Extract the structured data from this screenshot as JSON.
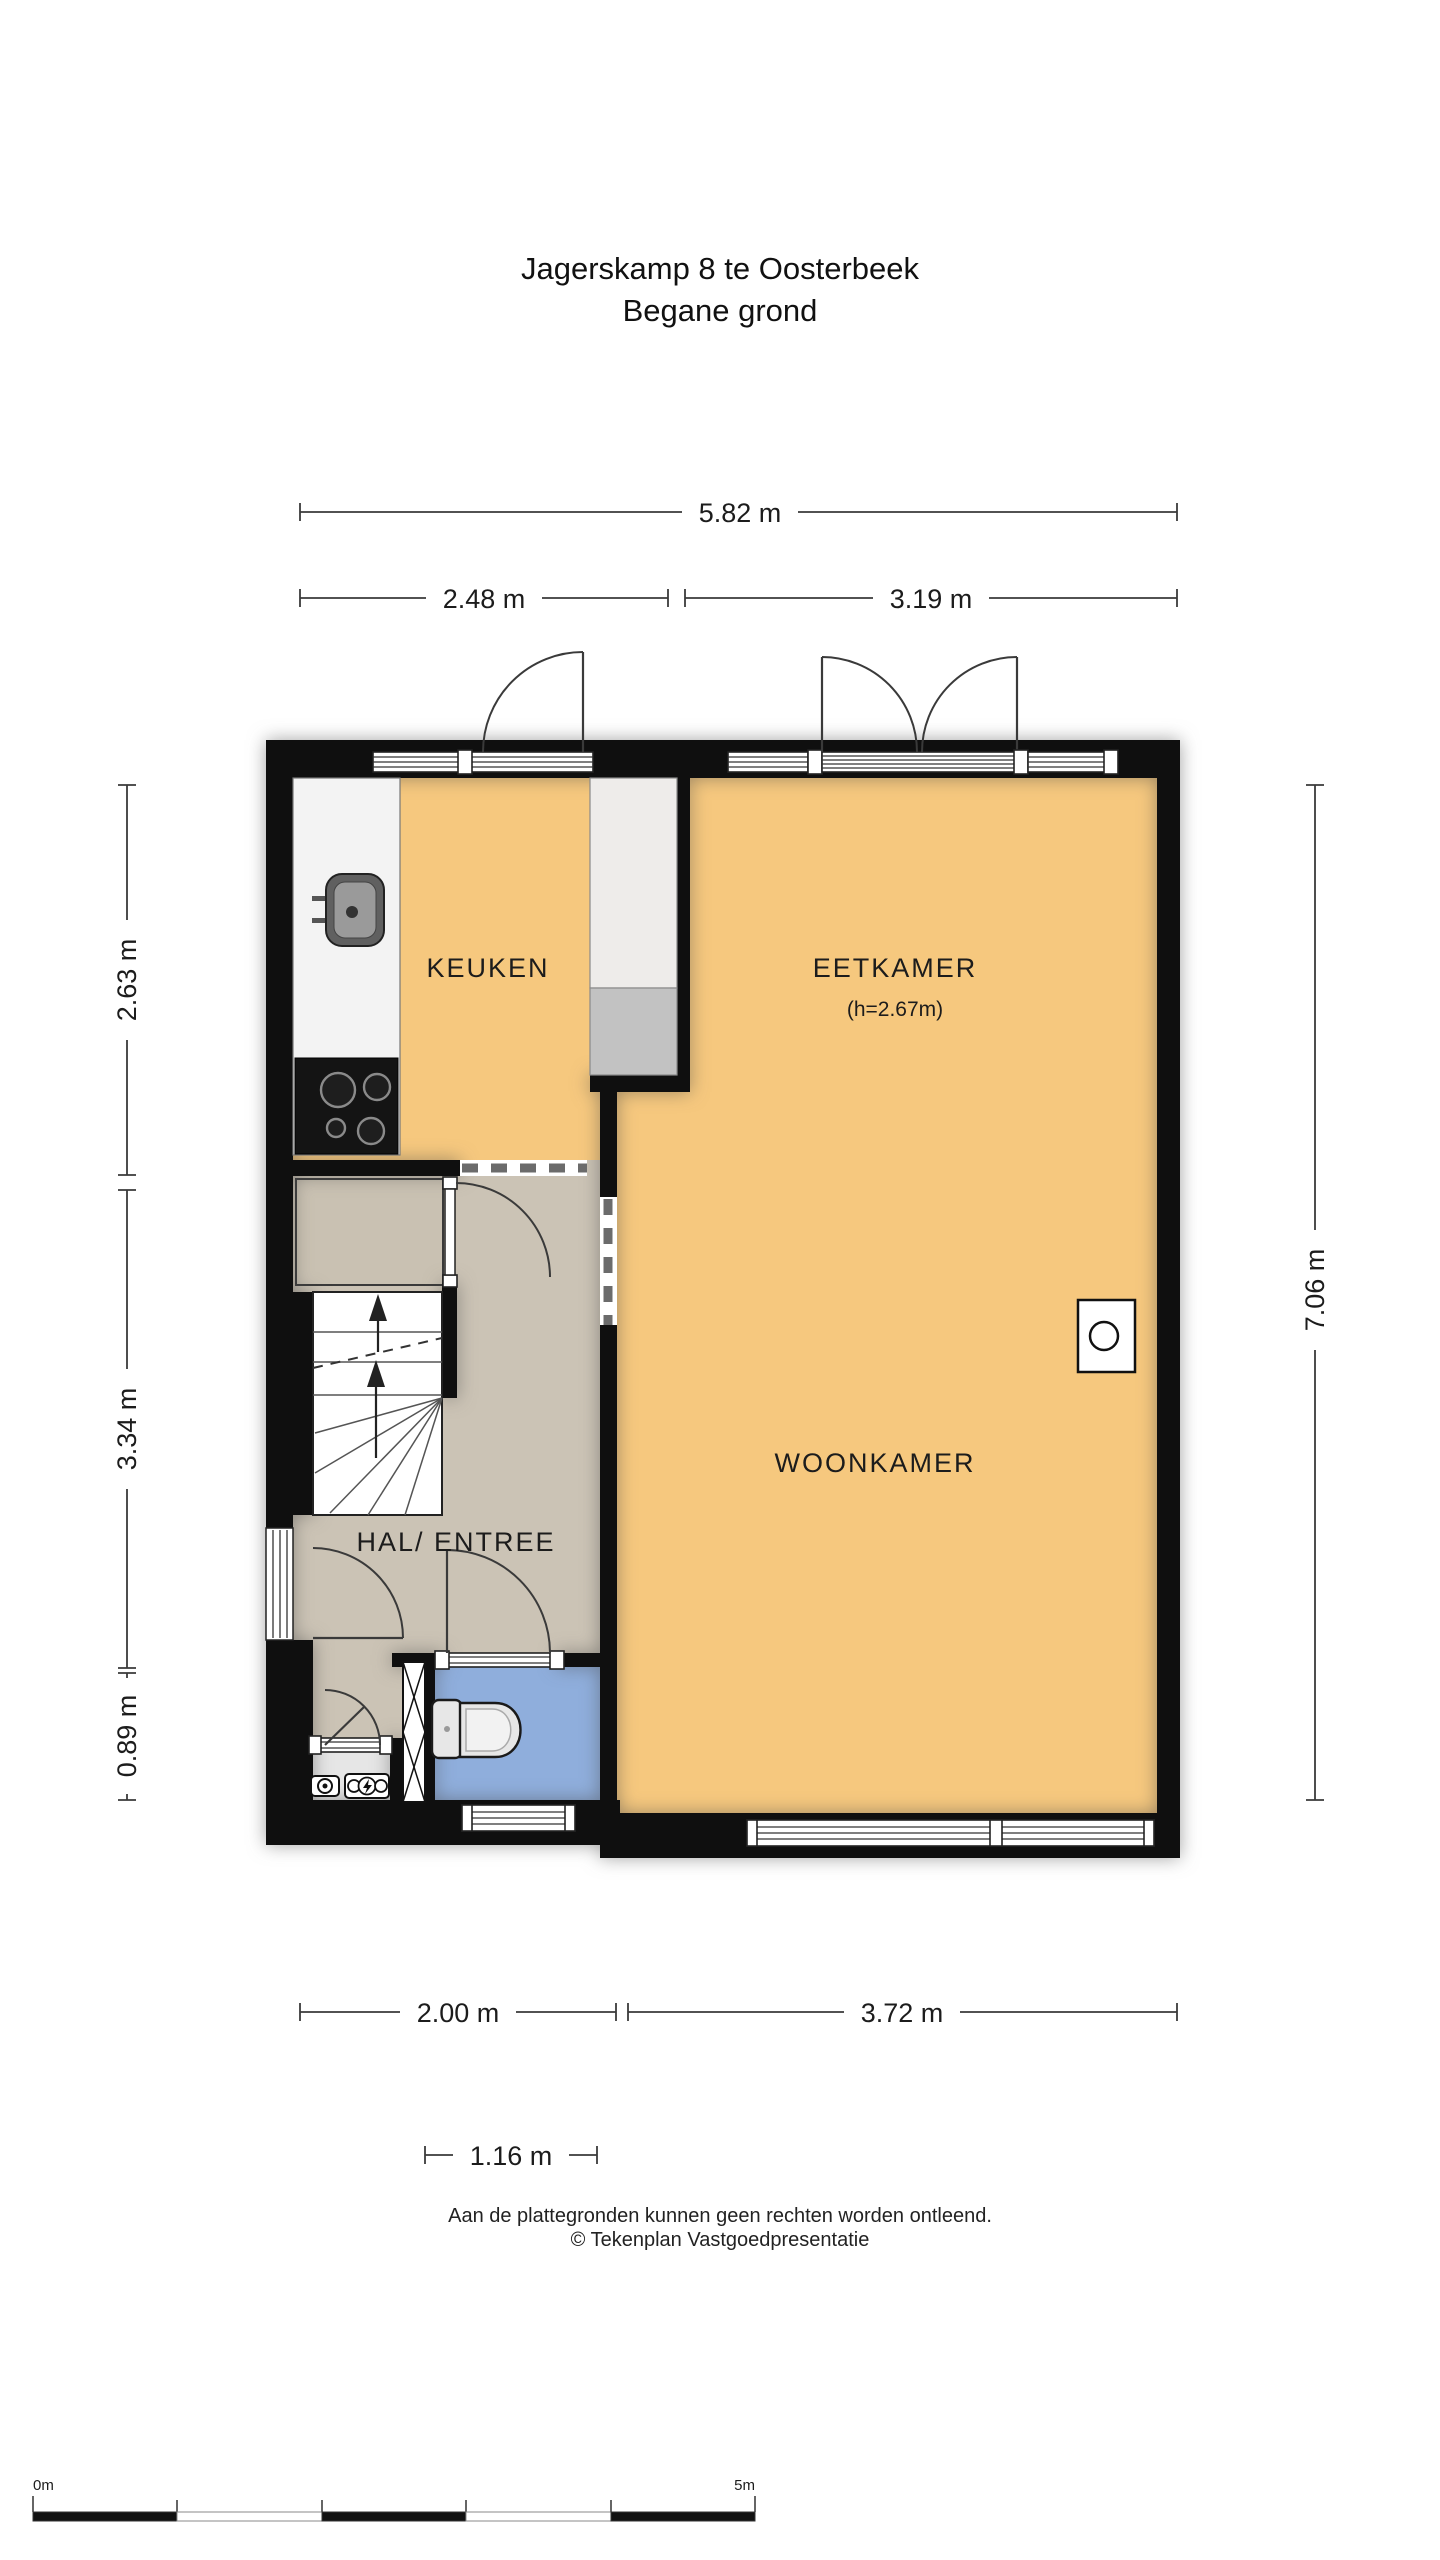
{
  "title": {
    "line1": "Jagerskamp 8 te Oosterbeek",
    "line2": "Begane grond"
  },
  "rooms": {
    "kitchen": "KEUKEN",
    "dining": "EETKAMER",
    "dining_height": "(h=2.67m)",
    "living": "WOONKAMER",
    "hall": "HAL/ ENTREE"
  },
  "dimensions": {
    "top_total": "5.82 m",
    "top_left": "2.48 m",
    "top_right": "3.19 m",
    "left_top": "2.63 m",
    "left_middle": "3.34 m",
    "left_bottom": "0.89 m",
    "right_total": "7.06 m",
    "bottom_left": "2.00 m",
    "bottom_right": "3.72 m",
    "bottom_inner": "1.16 m"
  },
  "footer": {
    "disclaimer": "Aan de plattegronden kunnen geen rechten worden ontleend.",
    "copyright": "© Tekenplan Vastgoedpresentatie"
  },
  "scale_bar": {
    "start_label": "0m",
    "end_label": "5m"
  },
  "colors": {
    "wall": "#0f0f0f",
    "floor_main": "#F6C87E",
    "floor_hall": "#CBC3B5",
    "floor_closet": "#C9C1B2",
    "floor_toilet": "#8FAEDC",
    "cabinet": "#C2C2C2",
    "counter": "#F3F3F3"
  }
}
